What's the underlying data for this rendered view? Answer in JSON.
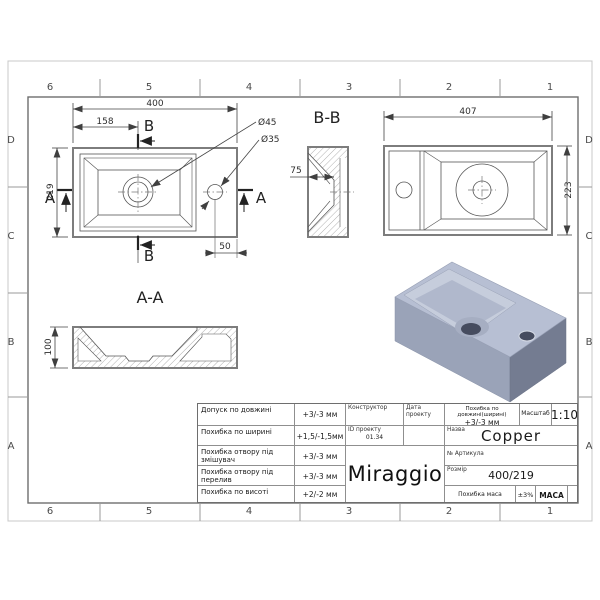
{
  "sheet": {
    "grid_columns": [
      "6",
      "5",
      "4",
      "3",
      "2",
      "1"
    ],
    "grid_rows": [
      "D",
      "C",
      "B",
      "A"
    ]
  },
  "views": {
    "top_view": {
      "dim_width": "400",
      "dim_left_to_drain": "158",
      "dim_height": "219",
      "dim_hole_to_edge": "50",
      "drain_diameter": "Ø45",
      "faucet_diameter": "Ø35",
      "section_a": "A",
      "section_b": "B"
    },
    "section_bb": {
      "title": "B-B",
      "dim_depth": "75"
    },
    "bottom_view": {
      "dim_width": "407",
      "dim_height": "223"
    },
    "section_aa": {
      "title": "A-A",
      "dim_height": "100"
    }
  },
  "title_block": {
    "tolerances": [
      {
        "label": "Допуск по довжині",
        "value": "+3/-3 мм"
      },
      {
        "label": "Похибка по ширині",
        "value": "+1,5/-1,5мм"
      },
      {
        "label": "Похибка отвору під змішувач",
        "value": "+3/-3 мм"
      },
      {
        "label": "Похибка отвору під перелив",
        "value": "+3/-3 мм"
      },
      {
        "label": "Похибка по висоті",
        "value": "+2/-2 мм"
      }
    ],
    "constructor_label": "Конструктор",
    "date_label": "Дата проекту",
    "project_id_label": "ID проекту",
    "project_id_value": "01.34",
    "brand": "Miraggio",
    "length_tolerance_label": "Похибка по довжині(ширині)",
    "length_tolerance_value": "+3/-3 мм",
    "scale_label": "Масштаб",
    "scale_value": "1:10",
    "name_label": "Назва",
    "name_value": "Copper",
    "article_label": "№ Артикула",
    "size_label": "Розмір",
    "size_value": "400/219",
    "mass_tolerance_label": "Похибка маса",
    "mass_tolerance_value": "±3%",
    "mass_label": "МАСА"
  },
  "colors": {
    "line_thick": "#7d7d7d",
    "line_thin": "#555555",
    "render_top": "#b7bfd3",
    "render_front": "#9aa3b8",
    "render_side": "#747c91",
    "render_hole": "#464c5f"
  }
}
